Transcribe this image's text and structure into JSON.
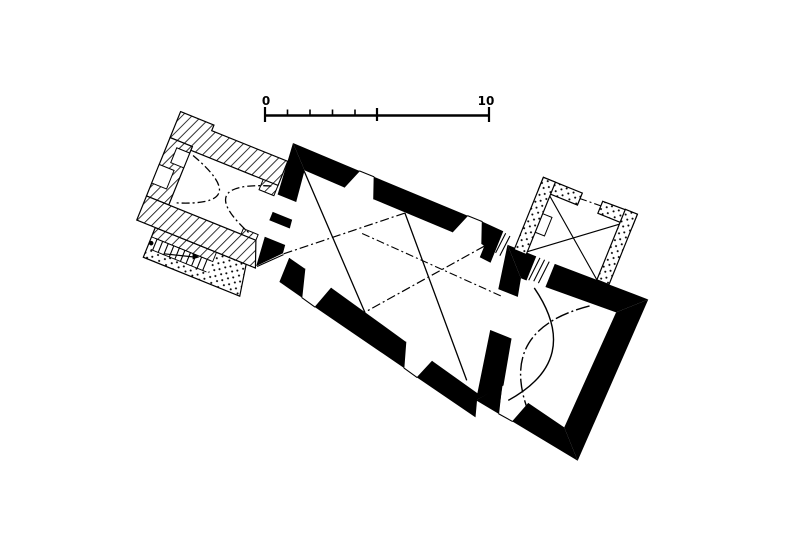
{
  "image": {
    "kind": "architectural-floor-plan",
    "paper_color": "#ffffff",
    "ink_color": "#000000",
    "rotation_deg": 22
  },
  "scale_bar": {
    "label_start": "0",
    "label_end": "10",
    "small_ticks_in_left_half": 4,
    "major_ticks": 3,
    "position": "top-center"
  },
  "plan": {
    "parts": [
      {
        "name": "west-tower",
        "wall_style": "hatched",
        "features": [
          "crossing dash-dot vault arcs",
          "rebated west doorway",
          "double arch to nave"
        ]
      },
      {
        "name": "stair-annex",
        "wall_style": "thin-outline-stippled",
        "features": [
          "stair rungs",
          "direction arrow",
          "survey dot"
        ]
      },
      {
        "name": "nave",
        "wall_style": "solid-black",
        "features": [
          "2 splayed north windows",
          "2 splayed south windows",
          "south door",
          "bay diagonals",
          "dash-dot ridge line",
          "northeast passage with steps"
        ]
      },
      {
        "name": "chancel",
        "wall_style": "solid-black",
        "features": [
          "chancel arch opening",
          "crossing vault arcs",
          "splayed south window",
          "steps to sacristy"
        ]
      },
      {
        "name": "sacristy",
        "wall_style": "stippled",
        "features": [
          "north doorway",
          "crossing diagonals",
          "wall niche"
        ]
      }
    ]
  }
}
